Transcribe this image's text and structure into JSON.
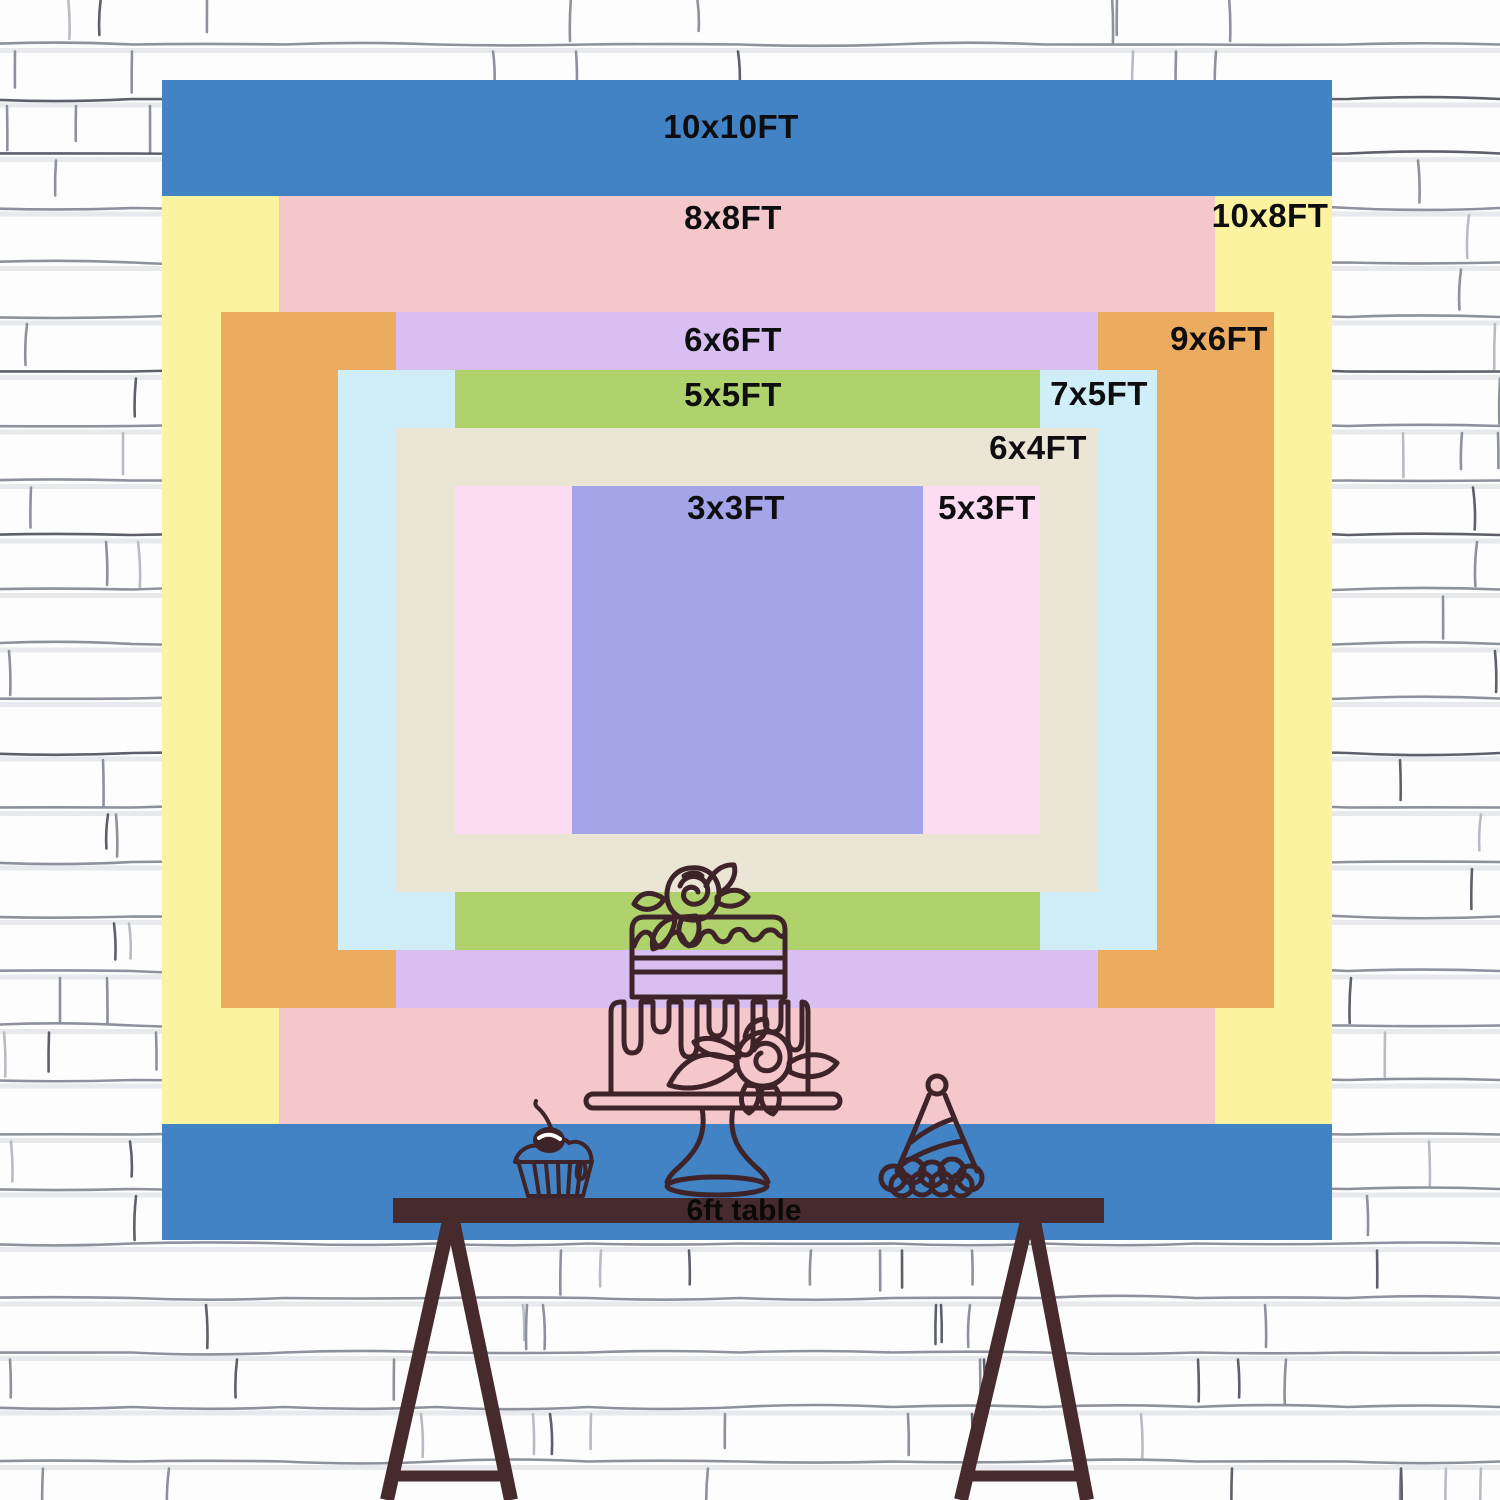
{
  "scene": {
    "description_text_color": "#0e0e10",
    "wall": {
      "background": "#f8f8f9",
      "brick_fill": "#fdfdfe",
      "mortar_line": "#8d919b",
      "mortar_dark": "#5d6069",
      "mortar_light": "#b8bbc3",
      "shadow_line": "#e4e5e9"
    }
  },
  "backdrop": {
    "unit": "FT",
    "sizes": [
      {
        "id": "10x10",
        "label": "10x10FT",
        "width_ft": 10,
        "height_ft": 10,
        "color": "#4183c5",
        "label_x": 731,
        "label_y": 127
      },
      {
        "id": "10x8",
        "label": "10x8FT",
        "width_ft": 10,
        "height_ft": 8,
        "color": "#fcf3a0",
        "label_x": 1270,
        "label_y": 216
      },
      {
        "id": "8x8",
        "label": "8x8FT",
        "width_ft": 8,
        "height_ft": 8,
        "color": "#f4c8ca",
        "label_x": 733,
        "label_y": 218
      },
      {
        "id": "9x6",
        "label": "9x6FT",
        "width_ft": 9,
        "height_ft": 6,
        "color": "#ecac60",
        "label_x": 1219,
        "label_y": 339
      },
      {
        "id": "6x6",
        "label": "6x6FT",
        "width_ft": 6,
        "height_ft": 6,
        "color": "#d9bef1",
        "label_x": 733,
        "label_y": 340
      },
      {
        "id": "7x5",
        "label": "7x5FT",
        "width_ft": 7,
        "height_ft": 5,
        "color": "#cfeef8",
        "label_x": 1099,
        "label_y": 394
      },
      {
        "id": "5x5",
        "label": "5x5FT",
        "width_ft": 5,
        "height_ft": 5,
        "color": "#afd26d",
        "label_x": 733,
        "label_y": 395
      },
      {
        "id": "6x4",
        "label": "6x4FT",
        "width_ft": 6,
        "height_ft": 4,
        "color": "#eae5d4",
        "label_x": 1038,
        "label_y": 448
      },
      {
        "id": "5x3",
        "label": "5x3FT",
        "width_ft": 5,
        "height_ft": 3,
        "color": "#fcdcf2",
        "label_x": 987,
        "label_y": 508
      },
      {
        "id": "3x3",
        "label": "3x3FT",
        "width_ft": 3,
        "height_ft": 3,
        "color": "#a4a4ea",
        "label_x": 736,
        "label_y": 508
      }
    ]
  },
  "table": {
    "label": "6ft table",
    "color": "#472a2d",
    "label_color": "#0a0a0a",
    "label_x": 744,
    "label_y": 1211
  },
  "artwork": {
    "line_color": "#3e2428",
    "items": [
      "cake-icon",
      "cupcake-icon",
      "party-hat-icon"
    ]
  }
}
